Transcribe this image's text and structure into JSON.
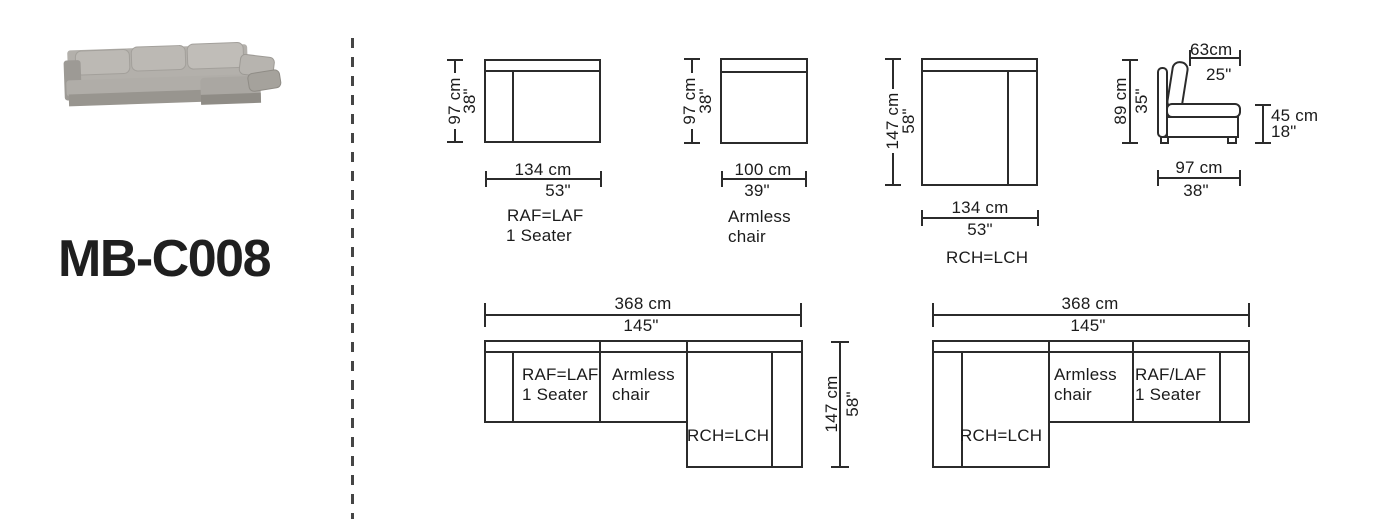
{
  "product": {
    "model": "MB-C008"
  },
  "palette": {
    "ink": "#2b2b2b",
    "text": "#1b1b1b",
    "sofa_grey": "#aeaba6"
  },
  "modules": {
    "one_seater": {
      "name_line1": "RAF=LAF",
      "name_line2": "1 Seater",
      "width_cm": "134 cm",
      "width_in": "53\"",
      "depth_cm": "97 cm",
      "depth_in": "38\""
    },
    "armless": {
      "name_line1": "Armless",
      "name_line2": "chair",
      "width_cm": "100 cm",
      "width_in": "39\"",
      "depth_cm": "97 cm",
      "depth_in": "38\""
    },
    "chaise": {
      "name": "RCH=LCH",
      "width_cm": "134 cm",
      "width_in": "53\"",
      "depth_cm": "147 cm",
      "depth_in": "58\""
    },
    "side_view": {
      "back_depth_cm": "63cm",
      "back_depth_in": "25\"",
      "height_cm": "89 cm",
      "height_in": "35\"",
      "seat_height_cm": "45 cm",
      "seat_height_in": "18\"",
      "total_depth_cm": "97 cm",
      "total_depth_in": "38\""
    }
  },
  "layouts": {
    "left": {
      "width_cm": "368 cm",
      "width_in": "145\"",
      "depth_cm": "147 cm",
      "depth_in": "58\"",
      "s1_line1": "RAF=LAF",
      "s1_line2": "1 Seater",
      "s2_line1": "Armless",
      "s2_line2": "chair",
      "s3": "RCH=LCH"
    },
    "right": {
      "width_cm": "368 cm",
      "width_in": "145\"",
      "s1": "RCH=LCH",
      "s2_line1": "Armless",
      "s2_line2": "chair",
      "s3_line1": "RAF/LAF",
      "s3_line2": "1 Seater"
    }
  }
}
